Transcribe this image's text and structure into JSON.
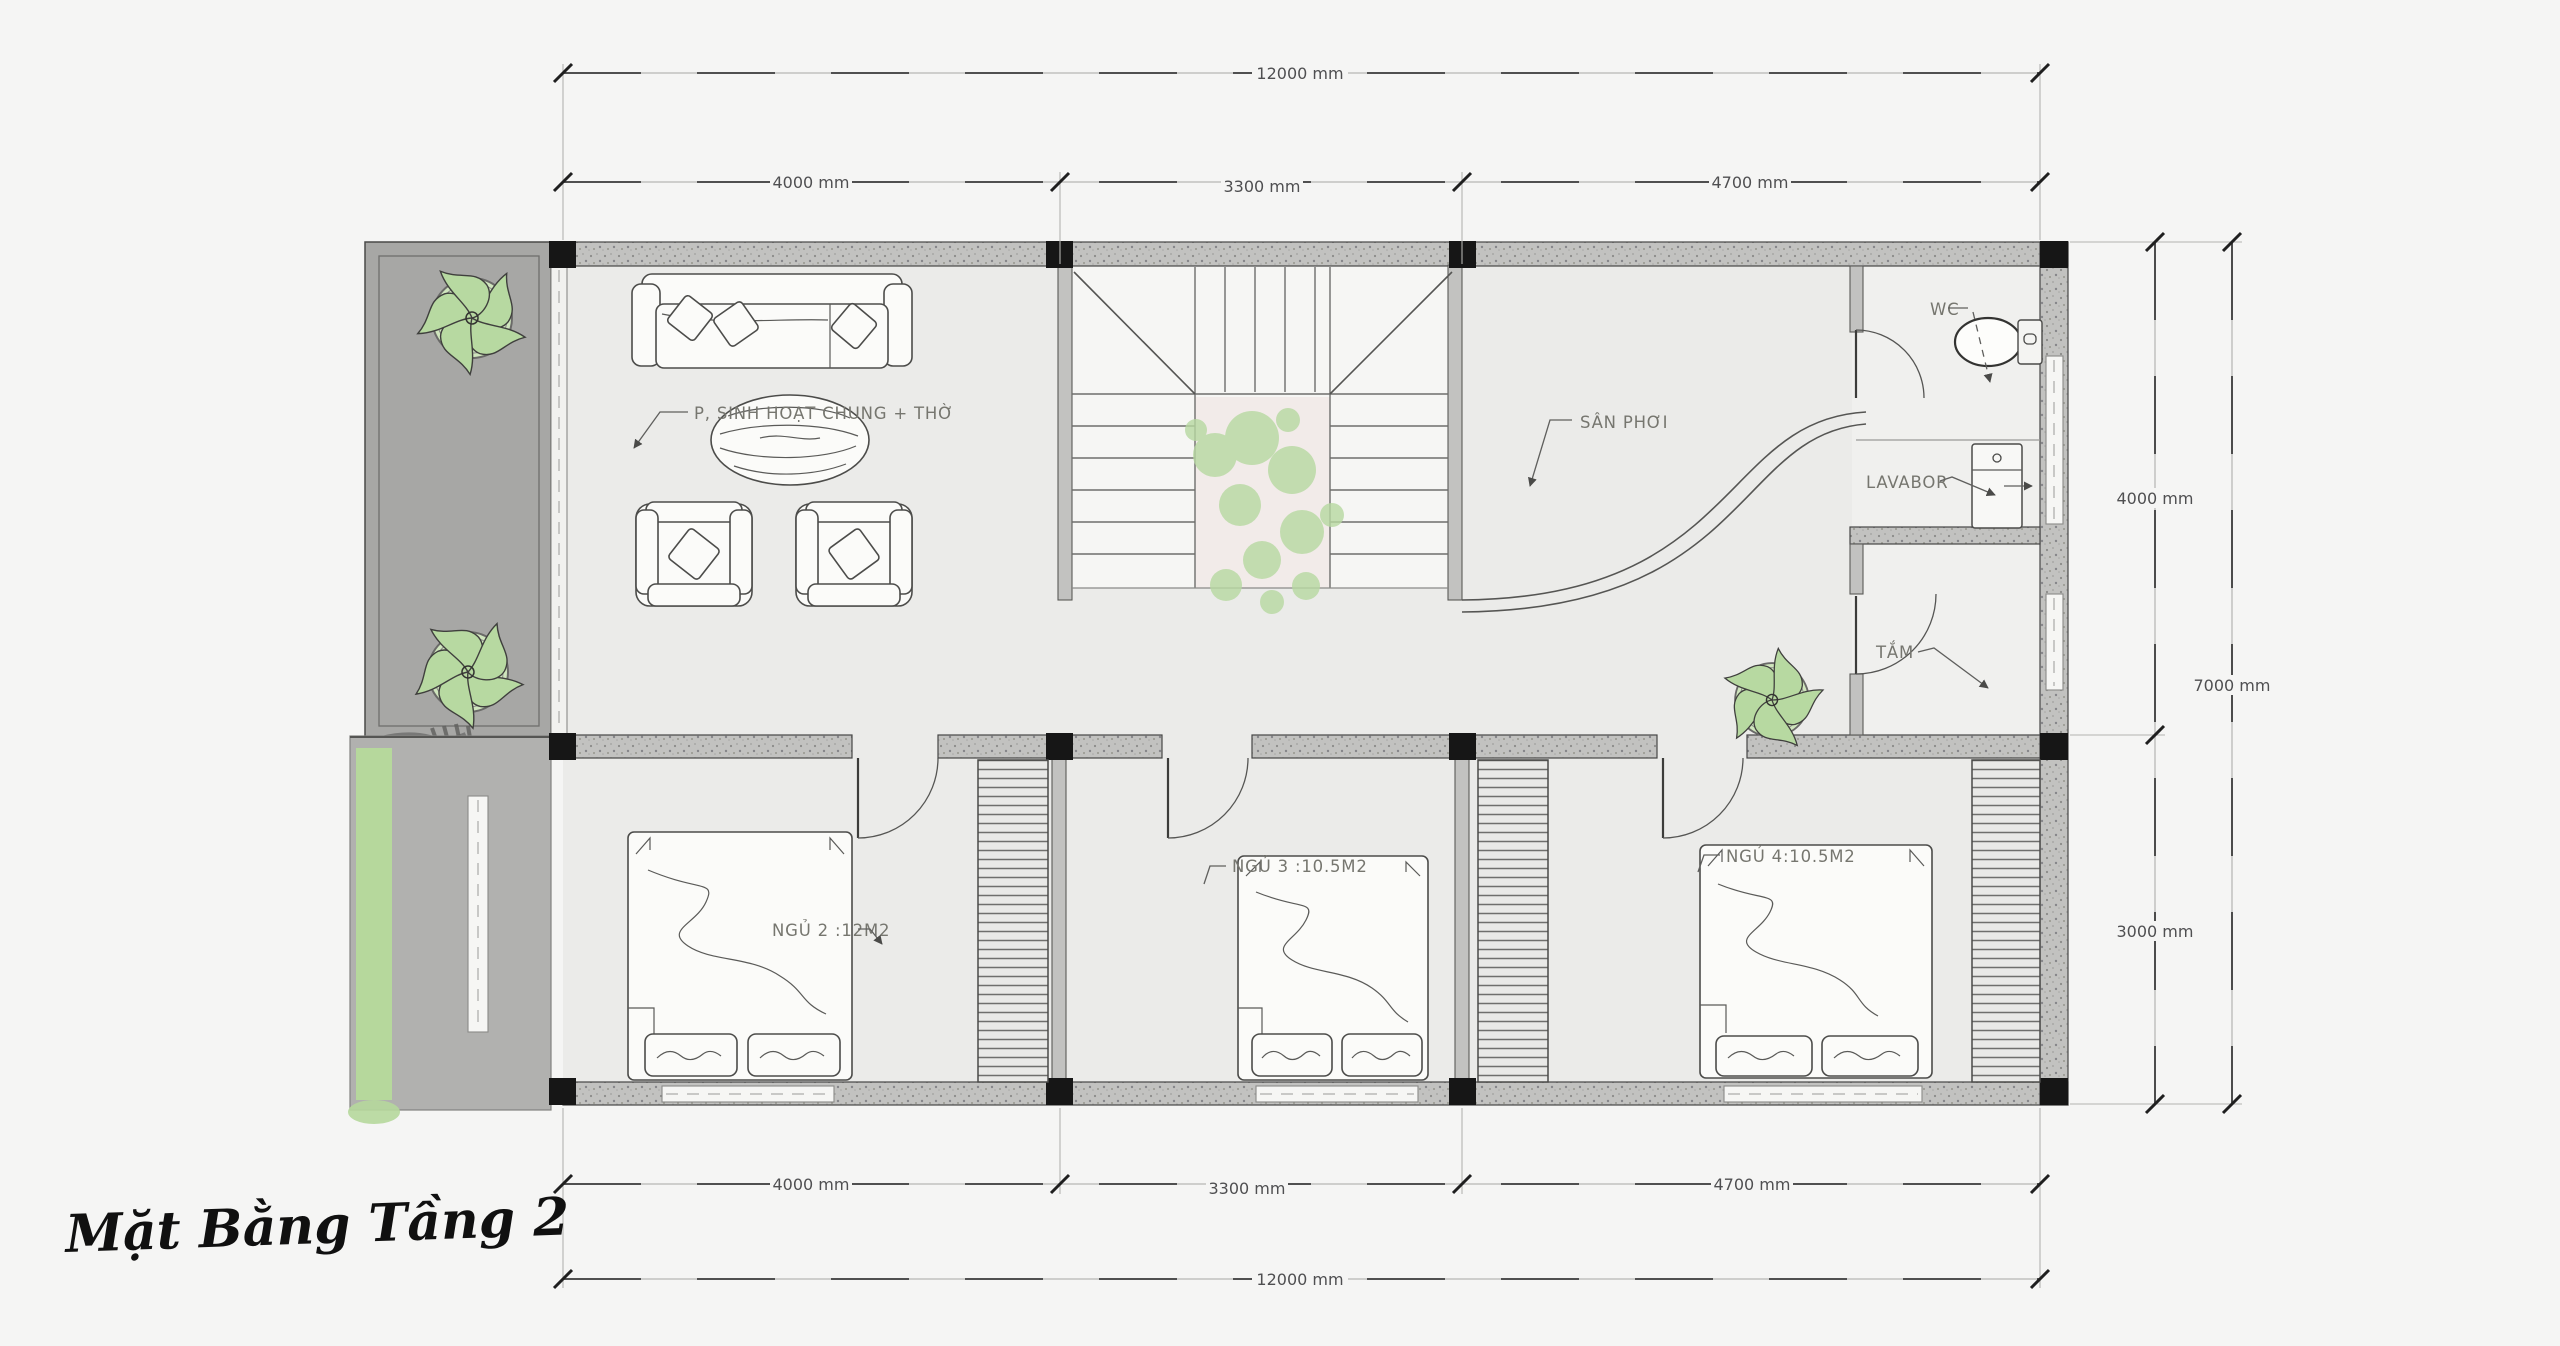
{
  "title": "Mặt Bằng Tầng 2",
  "rooms": {
    "living": "P, SINH HOẠT CHUNG + THỜ",
    "drying_yard": "SÂN PHƠI",
    "wc": "WC",
    "lavatory": "LAVABOR",
    "bath": "TẮM",
    "bedroom2": "NGỦ 2 :12M2",
    "bedroom3": "NGỦ 3 :10.5M2",
    "bedroom4": "NGỦ 4:10.5M2"
  },
  "dims": {
    "t_total": "12000 mm",
    "t1": "4000 mm",
    "t2": "3300 mm",
    "t3": "4700 mm",
    "r1": "4000 mm",
    "r2": "3000 mm",
    "r_total": "7000 mm",
    "b1": "4000 mm",
    "b2": "3300 mm",
    "b3": "4700 mm",
    "b_total": "12000 mm"
  },
  "colors": {
    "background": "#f5f5f4",
    "floor": "#ebebe9",
    "stair_floor": "#f6f6f4",
    "bath_floor": "#f0f0ee",
    "stair_void": "#f2ebe9",
    "balcony_floor": "#a7a7a5",
    "outdoor_strip": "#b1b1af",
    "grass": "#b6d89c",
    "column": "#161616",
    "plant_leaf": "#b7d9a1",
    "plant_pot": "#cfe5bd",
    "dim_text": "#4f4f51",
    "label_text": "#76766f",
    "title_color": "#101010"
  }
}
